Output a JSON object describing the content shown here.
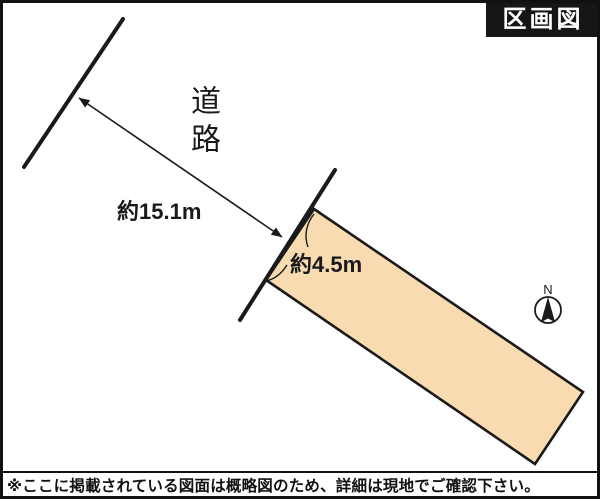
{
  "title": "区画図",
  "road": {
    "label": "道路"
  },
  "dimensions": {
    "road_distance": "約15.1m",
    "frontage": "約4.5m"
  },
  "compass": {
    "north_label": "N"
  },
  "disclaimer": "※ここに掲載されている図面は概略図のため、詳細は現地でご確認下さい。",
  "colors": {
    "plot_fill": "#F8DBB0",
    "ink": "#1A1A1A",
    "title_bg": "#161616",
    "title_text": "#FFFFFF"
  }
}
